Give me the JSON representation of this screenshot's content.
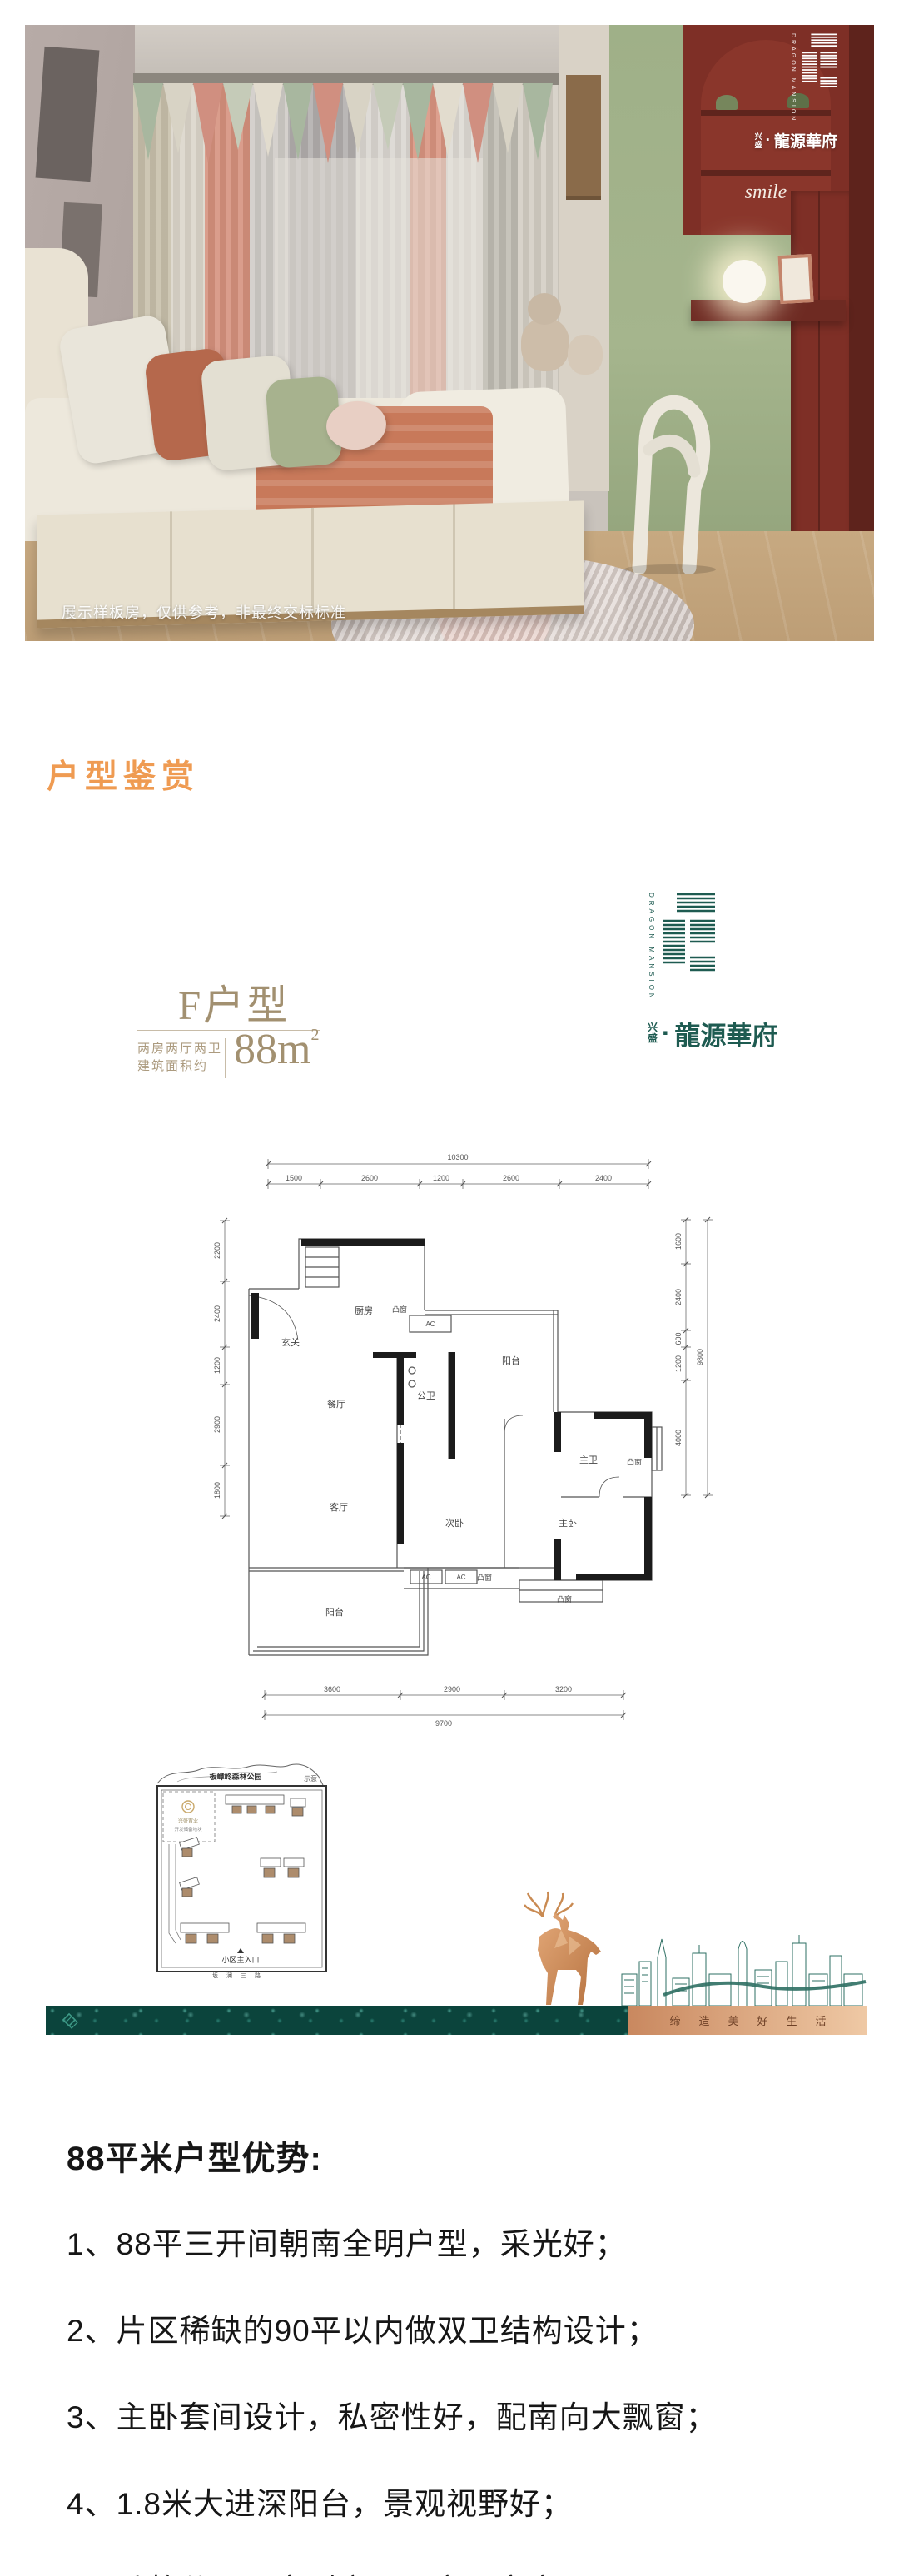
{
  "photo": {
    "disclaimer": "展示样板房，仅供参考，非最终交标标准",
    "smile_decor": "smile"
  },
  "brand": {
    "en_top": "DRAGON",
    "en_bottom": "MANSION",
    "prefix_top": "兴",
    "prefix_bottom": "盛",
    "dot": "·",
    "name": "龍源華府",
    "color": "#1E5B51"
  },
  "section": {
    "title": "户型鉴赏",
    "accent_color": "#EF9B52"
  },
  "unit": {
    "name": "F户型",
    "layout": "两房两厅两卫",
    "area_label": "建筑面积约",
    "area": "88",
    "area_unit": "m",
    "area_sup": "2"
  },
  "floorplan": {
    "dims": {
      "top_total": "10300",
      "top": [
        "1500",
        "2600",
        "1200",
        "2600",
        "2400"
      ],
      "left": [
        "2200",
        "2400",
        "1200",
        "2900",
        "1800"
      ],
      "right": [
        "1600",
        "2400",
        "600",
        "1200",
        "4000"
      ],
      "right_total": "9800",
      "bottom": [
        "3600",
        "2900",
        "3200"
      ],
      "bottom_total": "9700"
    },
    "rooms": {
      "entry": "玄关",
      "kitchen": "厨房",
      "dining": "餐厅",
      "living": "客厅",
      "pub_bath": "公卫",
      "balcony_top": "阳台",
      "balcony": "阳台",
      "bed2": "次卧",
      "bed1": "主卧",
      "m_bath": "主卫",
      "bay": "凸窗",
      "ac": "AC"
    }
  },
  "siteplan": {
    "park": "板嶂岭森林公园",
    "note": "示意",
    "plot_name": "兴盛置业",
    "plot_desc": "开发储备地块",
    "entrance": "小区主入口",
    "road": "坂澜三路"
  },
  "banner": {
    "slogan": "缔造美好生活",
    "teal_color": "#0B443C",
    "copper_color": "#D99B6C"
  },
  "advantages": {
    "title": "88平米户型优势:",
    "items": [
      "1、88平三开间朝南全明户型，采光好；",
      "2、片区稀缺的90平以内做双卫结构设计；",
      "3、主卧套间设计，私密性好，配南向大飘窗；",
      "4、1.8米大进深阳台，景观视野好；",
      "5、动静分区，户型方正，实用率高"
    ]
  }
}
